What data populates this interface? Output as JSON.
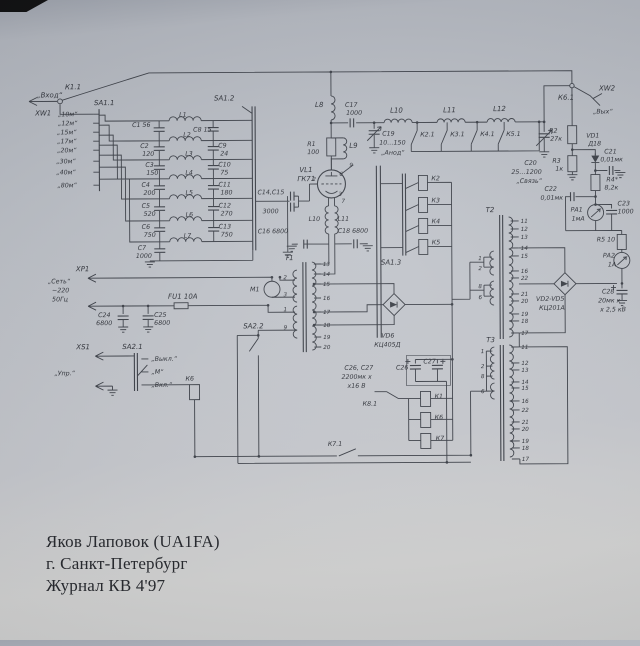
{
  "footer": {
    "line1": "Яков Лаповок (UA1FA)",
    "line2": "г. Санкт-Петербург",
    "line3": "Журнал КВ 4'97"
  },
  "input": {
    "label": "„Вход“",
    "xw1": "XW1",
    "k11": "К1.1",
    "sa11": "SA1.1",
    "sa12": "SA1.2",
    "sa13": "SA1.3"
  },
  "bands": [
    "„10м“",
    "„12м“",
    "„15м“",
    "„17м“",
    "„20м“",
    "„30м“",
    "„40м“",
    "„80м“"
  ],
  "filt": {
    "c1": "С1 56",
    "c8": "С8 15",
    "left": [
      [
        "С2",
        "120"
      ],
      [
        "С3",
        "150"
      ],
      [
        "С4",
        "200"
      ],
      [
        "С5",
        "520"
      ],
      [
        "С6",
        "750"
      ],
      [
        "С7",
        "1000"
      ]
    ],
    "right": [
      [
        "С9",
        "24"
      ],
      [
        "С10",
        "75"
      ],
      [
        "С11",
        "180"
      ],
      [
        "С12",
        "270"
      ],
      [
        "С13",
        "750"
      ]
    ],
    "coils": [
      "L1",
      "L2",
      "L3",
      "L4",
      "L5",
      "L6",
      "L7"
    ]
  },
  "tube": {
    "vl1": "VL1",
    "type": "ГК71",
    "l8": "L8",
    "c17": "С17",
    "c17v": "1000",
    "r1": "R1",
    "r1v": "100",
    "l9": "L9",
    "c1415": "С14,С15",
    "c1415v": "3000",
    "p2": "2",
    "p3": "3",
    "p6": "6",
    "p7": "7",
    "p9": "9",
    "l10": "L10",
    "l11": "L11",
    "c16": "С16 6800",
    "c18": "С18 6800"
  },
  "pi": {
    "l10": "L10",
    "l11": "L11",
    "l12": "L12",
    "k21": "К2.1",
    "k31": "К3.1",
    "k41": "К4.1",
    "k51": "К5.1",
    "c19": "С19",
    "c19v": "10…150",
    "c19n": "„Анод“"
  },
  "out": {
    "k61": "К6.1",
    "xw2": "XW2",
    "vyh": "„Вых“",
    "r2": "R2",
    "r2v": "27к",
    "vd1": "VD1",
    "vd1t": "Д18",
    "c21": "С21",
    "c21v": "0,01мк",
    "r3": "R3",
    "r3v": "1к",
    "c20": "С20",
    "c20v": "25…1200",
    "c20n": "„Связь“",
    "c22": "С22",
    "c22v": "0,01мк",
    "r4": "R4*",
    "r4v": "8,2к",
    "pa1": "РА1",
    "pa1v": "1мА",
    "c23": "С23",
    "c23v": "1000",
    "r5": "R5 10",
    "pa2": "РА2",
    "pa2v": "1А",
    "c28": "С28",
    "c28v": "20мк х",
    "c28v2": "х 2,5 кВ",
    "vd25": "VD2-VD5",
    "vd25t": "КЦ201А"
  },
  "rel": {
    "k2": "К2",
    "k3": "К3",
    "k4": "К4",
    "k5": "К5",
    "k1": "К1",
    "k6": "К6",
    "k7": "К7",
    "k81": "К8.1",
    "k71": "К7.1"
  },
  "psu": {
    "xp1": "ХР1",
    "net": "„Сеть“",
    "v220": "~220",
    "hz": "50Гц",
    "fu1": "FU1 10А",
    "c24": "С24",
    "c24v": "6800",
    "c25": "С25",
    "c25v": "6800",
    "xs1": "ХS1",
    "sa21": "SA2.1",
    "upr": "„Упр.“",
    "off": "„Выкл.“",
    "m": "„М“",
    "on": "„Вкл.“",
    "k6": "К6",
    "m1": "М1",
    "sa22": "SA2.2",
    "vd6": "VD6",
    "vd6t": "КЦ405Д",
    "note1": "С26, С27",
    "note2": "2200мк х",
    "note3": "х16 В",
    "c26": "С26",
    "c27": "С27"
  },
  "t1": {
    "label": "Т1",
    "lp": [
      "2",
      "3",
      "1",
      "9"
    ],
    "rp": [
      "13",
      "14",
      "15",
      "16",
      "17",
      "18",
      "19",
      "20"
    ]
  },
  "t2": {
    "label": "Т2",
    "lp": [
      "1",
      "2",
      "8",
      "6"
    ],
    "rp": [
      "11",
      "12",
      "13",
      "14",
      "15",
      "16",
      "22",
      "21",
      "20",
      "19",
      "18",
      "17"
    ]
  },
  "t3": {
    "label": "Т3",
    "lp": [
      "1",
      "2",
      "8",
      "6"
    ],
    "rp": [
      "11",
      "12",
      "13",
      "14",
      "15",
      "16",
      "22",
      "21",
      "20",
      "19",
      "18",
      "17"
    ]
  }
}
